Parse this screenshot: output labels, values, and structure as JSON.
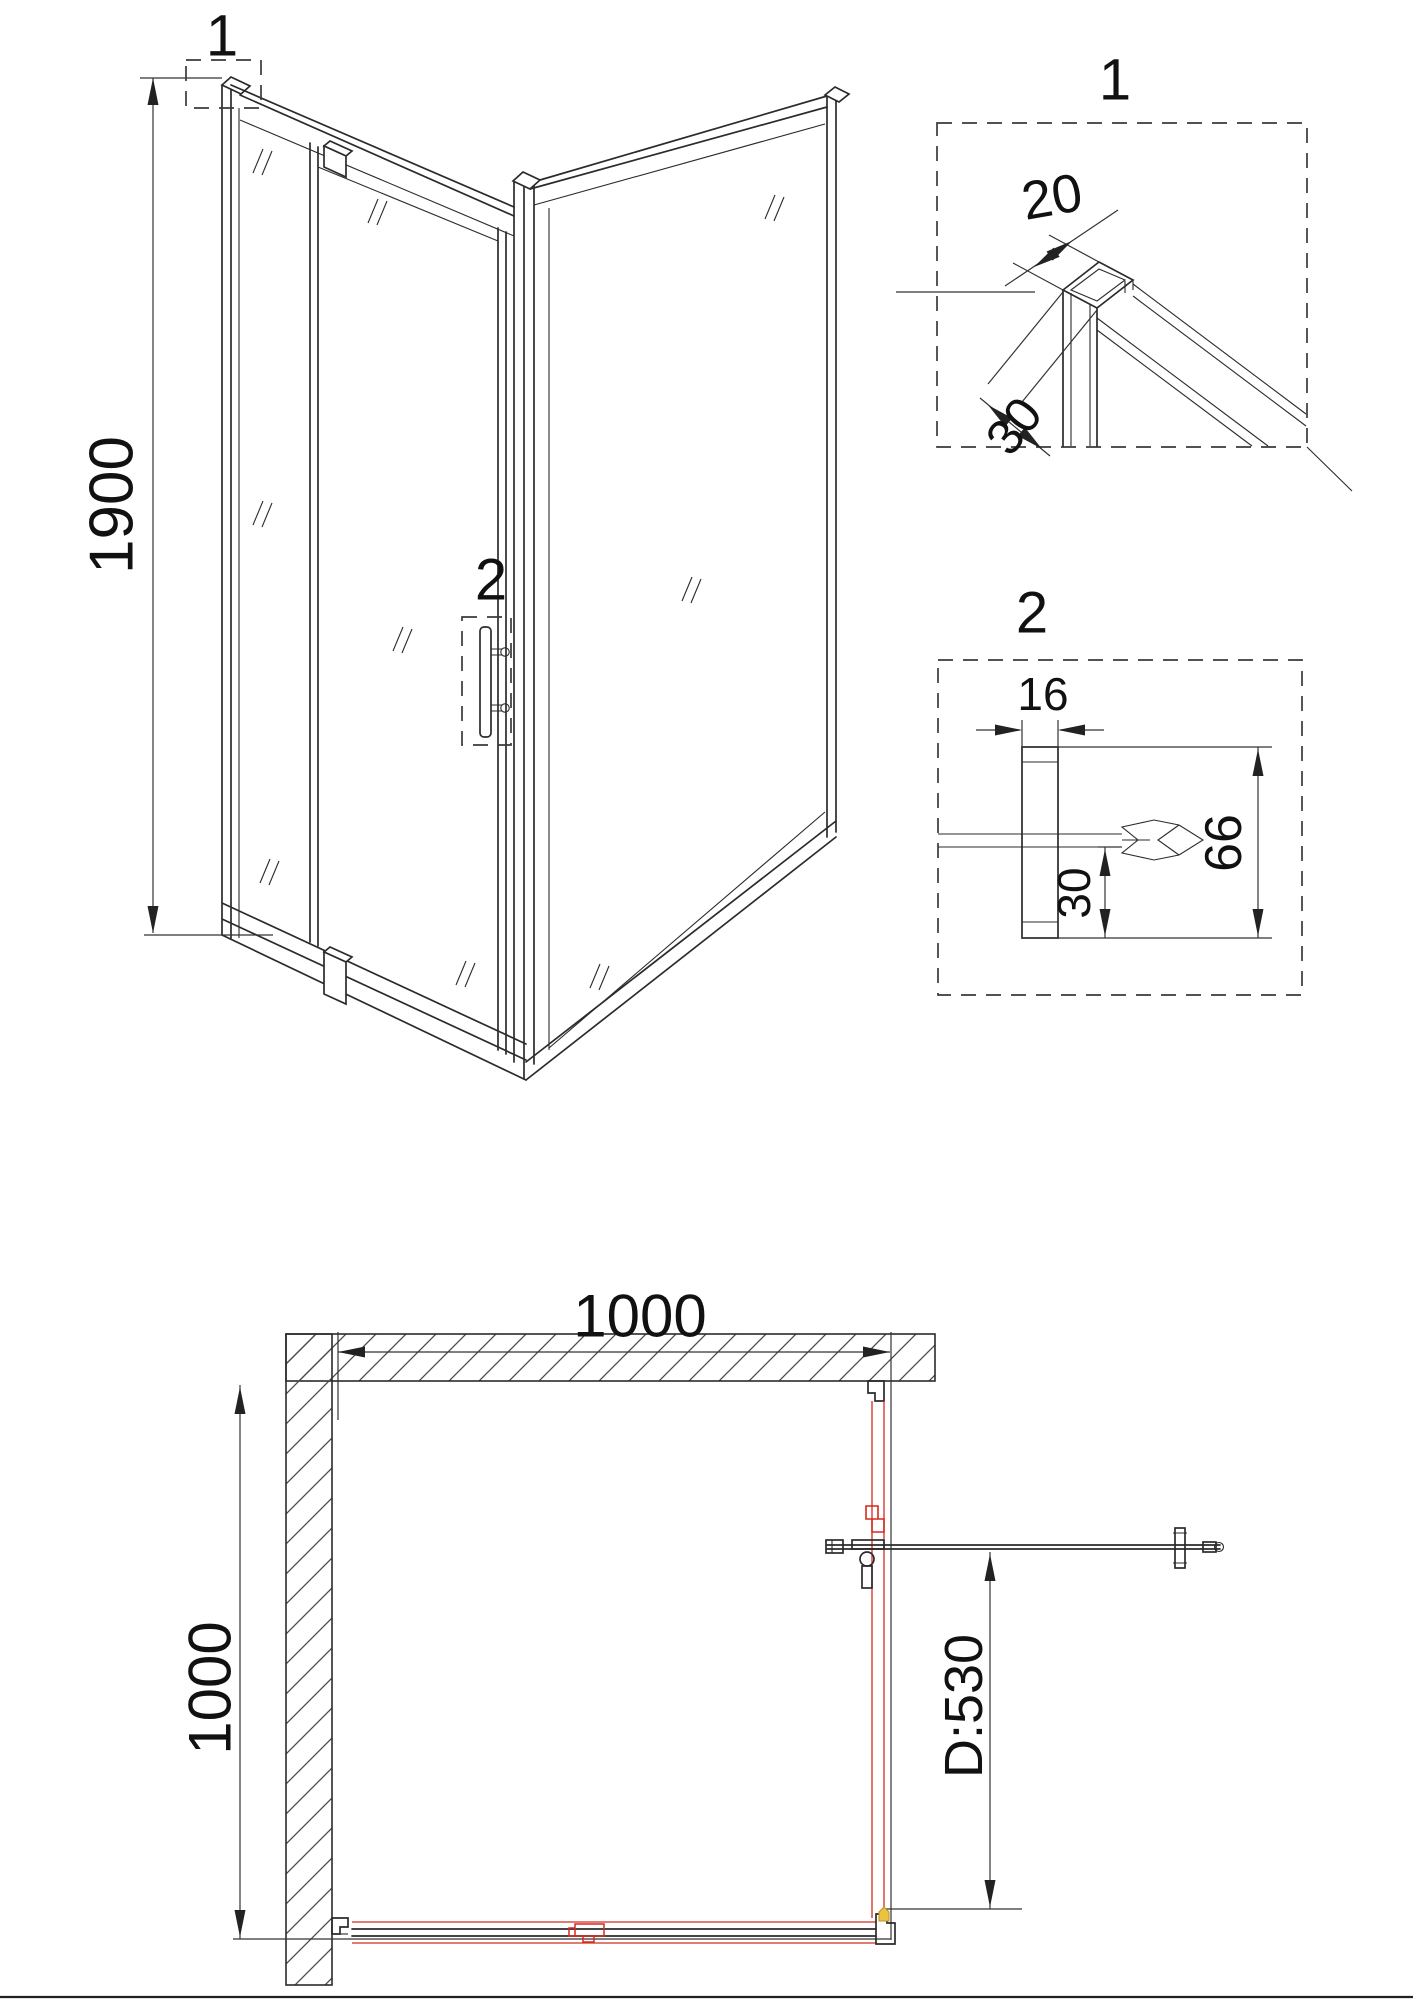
{
  "document": {
    "type": "technical-drawing",
    "subject": "corner shower enclosure with pivot door",
    "background": "#ffffff"
  },
  "colors": {
    "line": "#2b2b2b",
    "dimension": "#333333",
    "red_accent": "#d42a20",
    "yellow_accent": "#eac43e",
    "hatch": "#4a4a4a"
  },
  "iso_view": {
    "height_dim": "1900",
    "callout_top": "1",
    "callout_handle": "2"
  },
  "detail_1": {
    "title": "1",
    "width_dim": "20",
    "depth_dim": "30"
  },
  "detail_2": {
    "title": "2",
    "profile_width_dim": "16",
    "inset_dim": "30",
    "overall_dim": "66"
  },
  "plan_view": {
    "width_dim": "1000",
    "depth_dim": "1000",
    "door_width_dim": "D:530"
  }
}
